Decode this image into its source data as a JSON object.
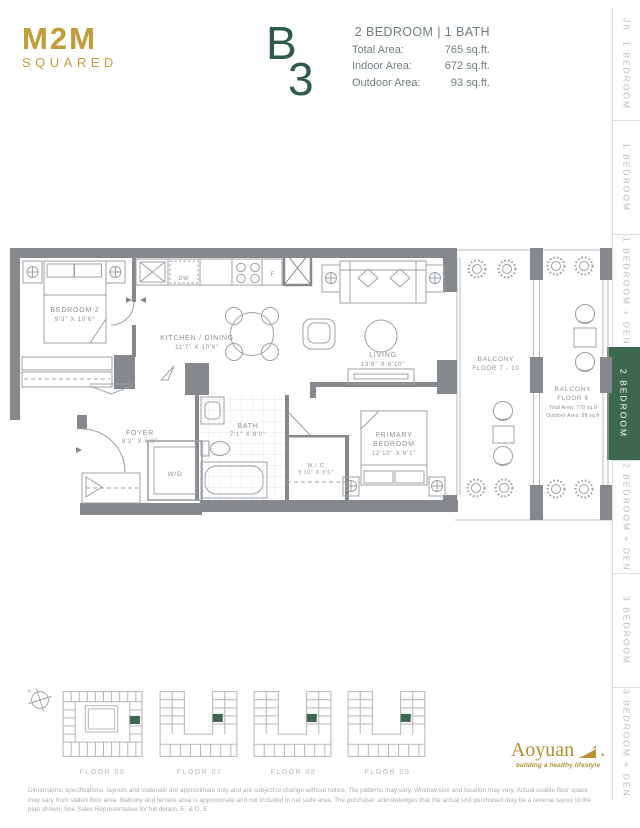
{
  "brand": {
    "logo_line1": "M2M",
    "logo_line2": "SQUARED"
  },
  "unit": {
    "letter": "B",
    "number": "3",
    "type": "2 BEDROOM | 1 BATH",
    "areas": [
      {
        "label": "Total Area:",
        "value": "765 sq.ft."
      },
      {
        "label": "Indoor Area:",
        "value": "672 sq.ft."
      },
      {
        "label": "Outdoor Area:",
        "value": "93 sq.ft."
      }
    ]
  },
  "sidebar": {
    "tabs": [
      {
        "label": "JR. 1 BEDROOM",
        "active": false
      },
      {
        "label": "1 BEDROOM",
        "active": false
      },
      {
        "label": "1 BEDROOM + DEN",
        "active": false
      },
      {
        "label": "2 BEDROOM",
        "active": true
      },
      {
        "label": "2 BEDROOM + DEN",
        "active": false
      },
      {
        "label": "3 BEDROOM",
        "active": false
      },
      {
        "label": "3 BEDROOM + DEN",
        "active": false
      }
    ]
  },
  "floorplan": {
    "rooms": {
      "bedroom2": {
        "name": "BEDROOM 2",
        "dims": "9'3\" X 10'6\""
      },
      "kitchen": {
        "name": "KITCHEN / DINING",
        "dims": "11'7\" X 10'9\""
      },
      "living": {
        "name": "LIVING",
        "dims": "13'6\" X 9'10\""
      },
      "foyer": {
        "name": "FOYER",
        "dims": "8'2\" X 6'0\""
      },
      "bath": {
        "name": "BATH",
        "dims": "7'1\" X 8'0\""
      },
      "wic": {
        "name": "W.I.C",
        "dims": "5'10\" X 3'6\""
      },
      "primary": {
        "name_line1": "PRIMARY",
        "name_line2": "BEDROOM",
        "dims": "12'10\" X 9'1\""
      },
      "wd": {
        "name": "W/D"
      }
    },
    "appliances": {
      "dishwasher": "DW",
      "fridge": "F"
    },
    "balconies": {
      "mid": {
        "name": "BALCONY",
        "floors": "FLOOR 7 - 10"
      },
      "right": {
        "name": "BALCONY",
        "floors": "FLOOR 6",
        "total_area": "Total Area: 770 sq.ft",
        "outdoor_area": "Outdoor Area: 98 sq.ft"
      }
    }
  },
  "keyplans": {
    "labels": [
      "FLOOR 06",
      "FLOOR 07",
      "FLOOR 08",
      "FLOOR 09"
    ],
    "compass": "N"
  },
  "footer": {
    "brand": "Aoyuan",
    "tagline": "building a healthy lifestyle",
    "disclaimer": "Dimensions, specifications, layouts and materials are approximate only and are subject to change without notice.  Tile patterns may vary.  Window size and location may vary.  Actual usable floor space may vary from stated floor area.  Balcony and terrace area is approximate and not included in net suite area.  The purchaser acknowledges that the actual unit purchased may be a reverse layout to the plan shown.  See Sales Representative for full details.  E. & O. E."
  },
  "colors": {
    "accent_green": "#3E6750",
    "gold": "#C19E3B",
    "wall_gray": "#85888C"
  }
}
